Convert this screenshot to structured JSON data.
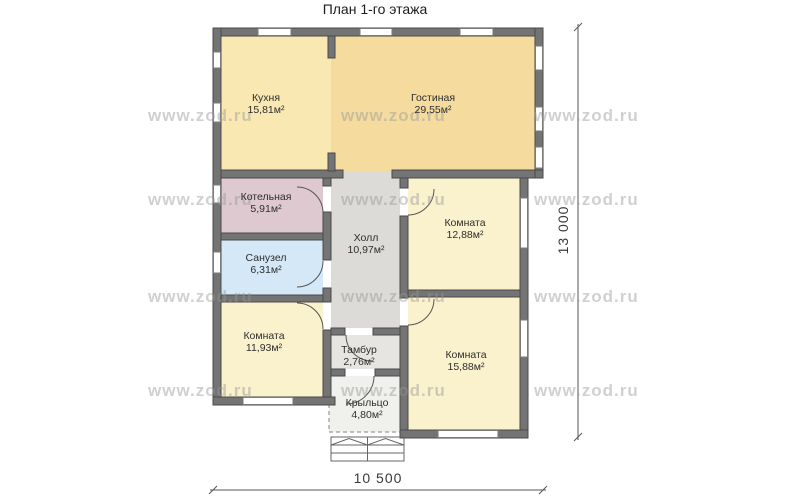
{
  "title": "План 1-го этажа",
  "watermark": {
    "text": "www.zod.ru"
  },
  "dims": {
    "width": "10 500",
    "height": "13 000"
  },
  "colors": {
    "wall": "#747474",
    "wall_stroke": "#4a4a4a",
    "window_fill": "#ffffff",
    "door": "#555555",
    "background": "#ffffff"
  },
  "rooms": [
    {
      "id": "kitchen",
      "name": "Кухня",
      "area": "15,81м²",
      "color": "#f9e8b2"
    },
    {
      "id": "living",
      "name": "Гостиная",
      "area": "29,55м²",
      "color": "#f5dc9e"
    },
    {
      "id": "boiler",
      "name": "Котельная",
      "area": "5,91м²",
      "color": "#ddc9cf"
    },
    {
      "id": "bathroom",
      "name": "Санузел",
      "area": "6,31м²",
      "color": "#d4e8f7"
    },
    {
      "id": "hall",
      "name": "Холл",
      "area": "10,97м²",
      "color": "#dcdbd8"
    },
    {
      "id": "room-1",
      "name": "Комната",
      "area": "12,88м²",
      "color": "#faf1cd"
    },
    {
      "id": "room-2",
      "name": "Комната",
      "area": "11,93м²",
      "color": "#faf1cd"
    },
    {
      "id": "tambour",
      "name": "Тамбур",
      "area": "2,76м²",
      "color": "#e6e5e2"
    },
    {
      "id": "room-3",
      "name": "Комната",
      "area": "15,88м²",
      "color": "#faf1cd"
    },
    {
      "id": "porch",
      "name": "Крыльцо",
      "area": "4,80м²",
      "color": "#f0f0ed"
    }
  ]
}
